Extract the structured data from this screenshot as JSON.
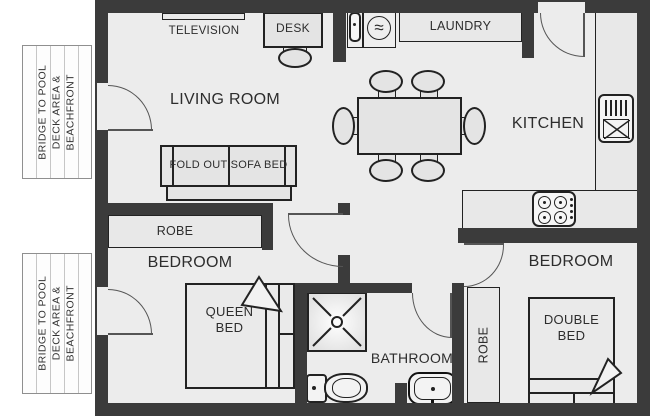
{
  "colors": {
    "wall": "#3b3b3b",
    "floor": "#ececec",
    "furniture": "#e4e4e4",
    "outline": "#222222",
    "doorline": "#555555",
    "text": "#2d2d2d"
  },
  "bridge_label": {
    "line1": "BRIDGE TO POOL",
    "line2": "DECK AREA &",
    "line3": "BEACHFRONT"
  },
  "rooms": {
    "living": "LIVING ROOM",
    "kitchen": "KITCHEN",
    "bedroom": "BEDROOM",
    "bathroom": "BATHROOM",
    "laundry": "LAUNDRY"
  },
  "furniture": {
    "television": "TELEVISION",
    "desk": "DESK",
    "sofa_bed": "FOLD OUT SOFA BED",
    "robe": "ROBE",
    "queen_bed_line1": "QUEEN",
    "queen_bed_line2": "BED",
    "double_bed_line1": "DOUBLE",
    "double_bed_line2": "BED"
  },
  "icons": {
    "washing_machine_glyph": "≈"
  }
}
